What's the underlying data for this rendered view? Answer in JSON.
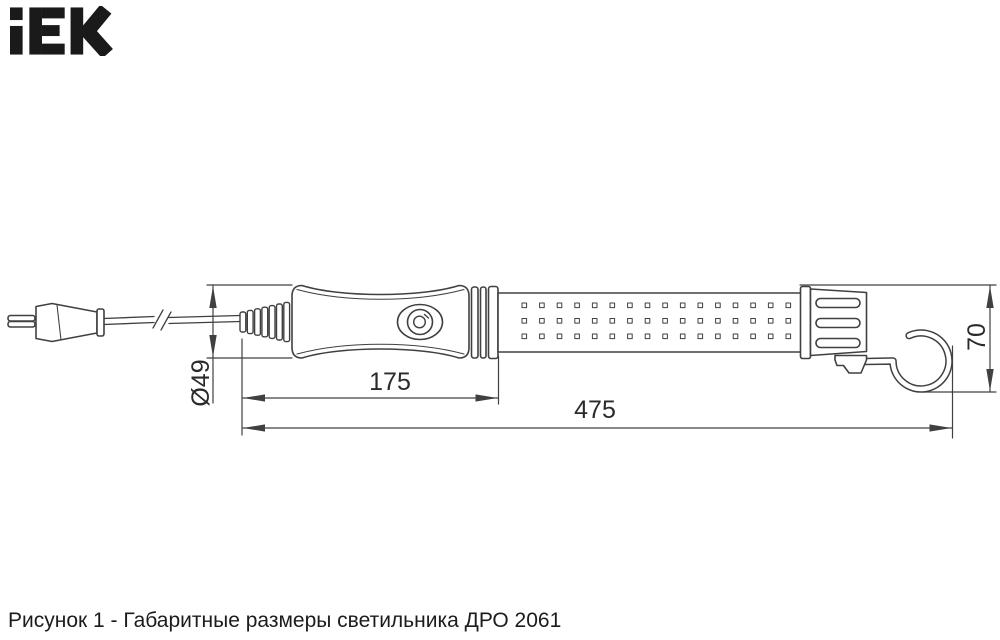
{
  "page": {
    "background": "#ffffff"
  },
  "logo": {
    "text": "iEK",
    "color": "#1a1a1a"
  },
  "caption": {
    "text": "Рисунок 1 - Габаритные размеры светильника ДРО 2061"
  },
  "drawing": {
    "line_color": "#404040",
    "parts": [
      "plug",
      "power-cord",
      "cord-break-symbol",
      "strain-relief",
      "handle",
      "power-button",
      "handle-collar",
      "lamp-tube",
      "led-grid",
      "end-collar",
      "end-cap",
      "hook-bracket",
      "hanging-hook"
    ],
    "led_grid": {
      "rows": 3,
      "columns": 16
    },
    "dimensions": {
      "diameter": {
        "label": "Ø49",
        "value": 49,
        "orientation": "vertical"
      },
      "handle_length": {
        "label": "175",
        "value": 175,
        "orientation": "horizontal"
      },
      "overall_length": {
        "label": "475",
        "value": 475,
        "orientation": "horizontal"
      },
      "end_height": {
        "label": "70",
        "value": 70,
        "orientation": "vertical"
      }
    }
  }
}
